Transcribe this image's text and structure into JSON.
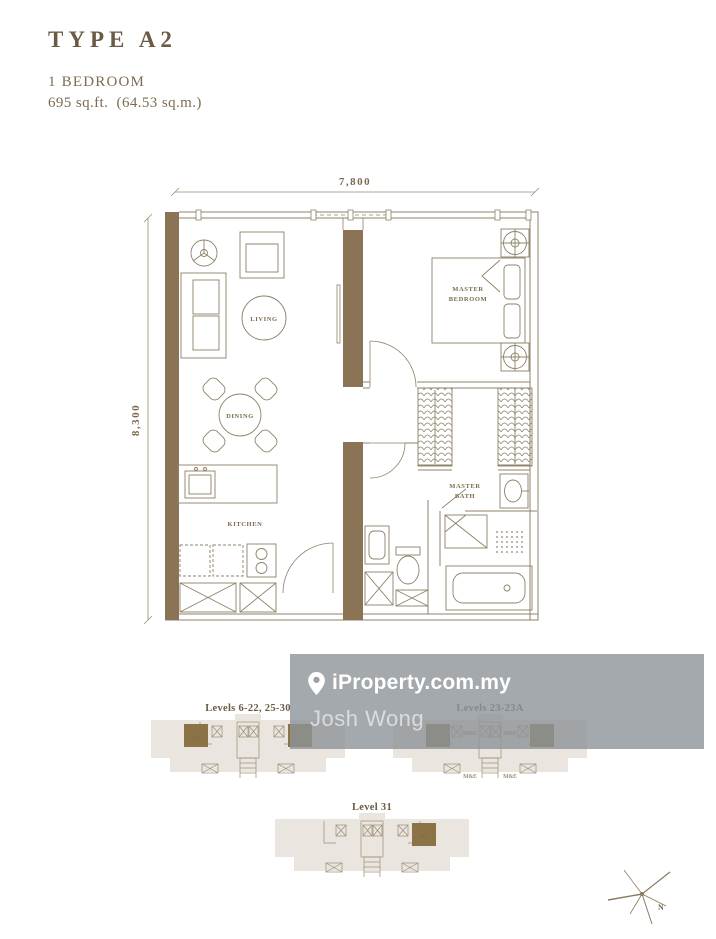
{
  "header": {
    "title": "TYPE A2",
    "bedrooms": "1 BEDROOM",
    "area": "695 sq.ft.  (64.53 sq.m.)"
  },
  "floorplan": {
    "dims": {
      "width": "7,800",
      "height": "8,300"
    },
    "rooms": {
      "living": "LIVING",
      "dining": "DINING",
      "kitchen": "KITCHEN",
      "master_bedroom_line1": "MASTER",
      "master_bedroom_line2": "BEDROOM",
      "master_bath_line1": "MASTER",
      "master_bath_line2": "BATH"
    }
  },
  "watermark": {
    "brand": "iProperty.com.my",
    "agent": "Josh Wong"
  },
  "keyplans": {
    "unit_label": "01",
    "me_label": "M&E",
    "plans": [
      {
        "label": "Levels 6-22, 25-30"
      },
      {
        "label": "Levels 23-23A"
      },
      {
        "label": "Level 31"
      }
    ]
  },
  "compass": {
    "north_label": "N"
  },
  "colors": {
    "accent_brown": "#6b5b44",
    "wall_brown": "#8b7355",
    "keyplan_brown": "#8b7346",
    "line_brown": "#8f8168",
    "keyplan_beige": "#eae6df",
    "watermark_gray": "#8d9399"
  }
}
